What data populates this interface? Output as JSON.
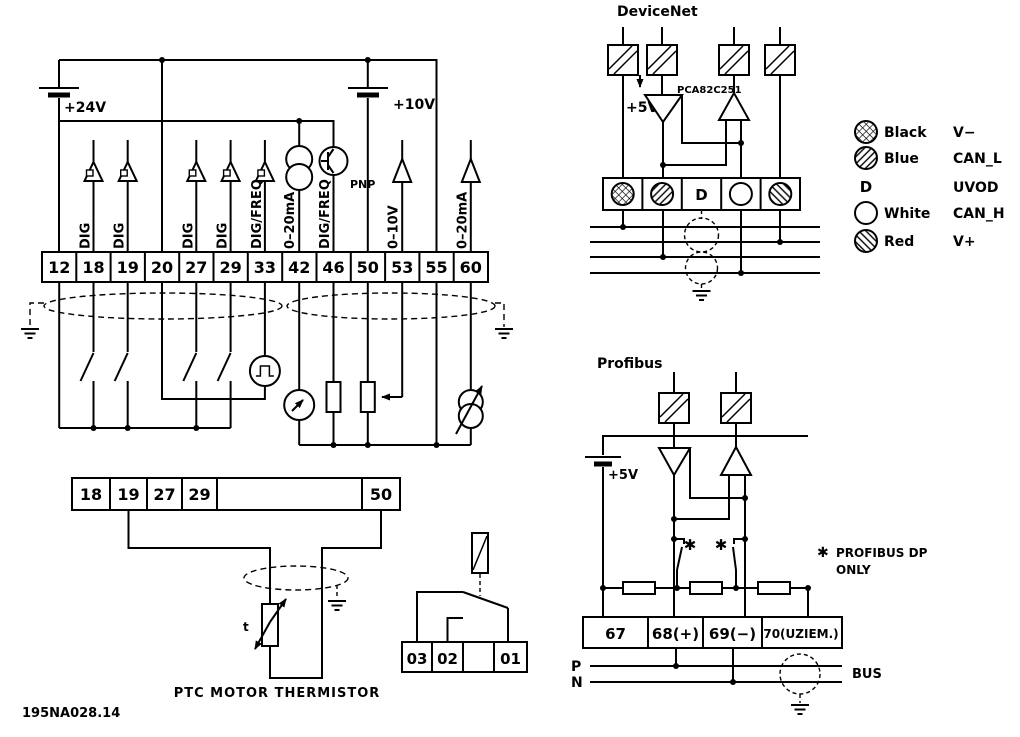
{
  "figure_id": "195NA028.14",
  "control": {
    "supply_24v": "+24V",
    "supply_10v": "+10V",
    "terminals": [
      "12",
      "18",
      "19",
      "20",
      "27",
      "29",
      "33",
      "42",
      "46",
      "50",
      "53",
      "55",
      "60"
    ],
    "signal_labels": {
      "t18": "DIG",
      "t19": "DIG",
      "t27": "DIG",
      "t29": "DIG",
      "t33": "DIG/FREQ",
      "t42": "0–20mA",
      "t46": "DIG/FREQ",
      "t53": "0–10V",
      "t60": "0–20mA"
    },
    "pnp_label": "PNP"
  },
  "thermistor": {
    "terminals": [
      "18",
      "19",
      "27",
      "29",
      "",
      "50"
    ],
    "t_label": "t",
    "caption": "PTC MOTOR THERMISTOR"
  },
  "relay": {
    "terminals": [
      "03",
      "02",
      "",
      "01"
    ]
  },
  "devicenet": {
    "title": "DeviceNet",
    "transceiver": "PCA82C251",
    "supply": "+5V",
    "terminal_d": "D",
    "legend": [
      {
        "color": "Black",
        "signal": "V−"
      },
      {
        "color": "Blue",
        "signal": "CAN_L"
      },
      {
        "color": "D",
        "signal": "UVOD"
      },
      {
        "color": "White",
        "signal": "CAN_H"
      },
      {
        "color": "Red",
        "signal": "V+"
      }
    ]
  },
  "profibus": {
    "title": "Profibus",
    "supply": "+5V",
    "terminals": [
      "67",
      "68(+)",
      "69(−)",
      "70(UZIEM.)"
    ],
    "note_marker": "✱",
    "note_line1": "PROFIBUS DP",
    "note_line2": "ONLY",
    "bus_p": "P",
    "bus_n": "N",
    "bus_label": "BUS"
  },
  "colors": {
    "ink": "#000000",
    "background": "#ffffff"
  }
}
